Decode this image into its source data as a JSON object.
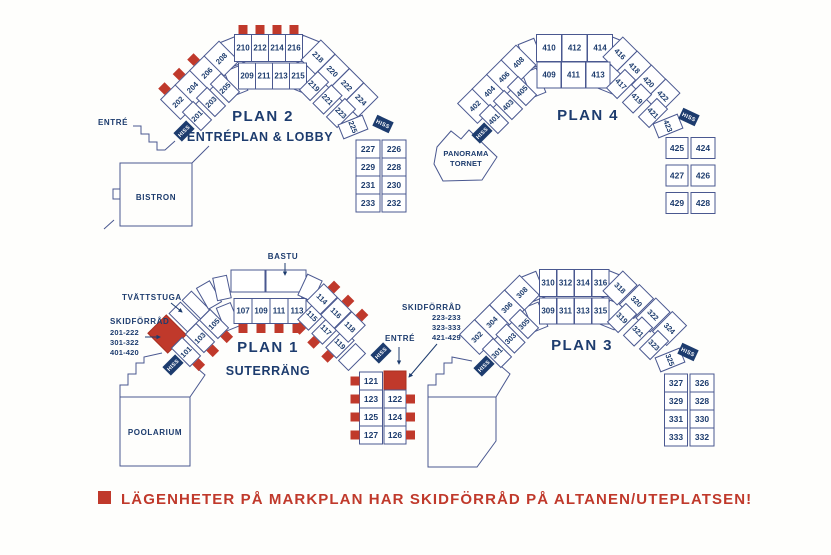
{
  "colors": {
    "navy_text": "#1d3c6e",
    "line": "#4a5890",
    "red_marker": "#c0392b",
    "hiss_background": "#1d3c6e",
    "hiss_text": "#ffffff",
    "background": "#fefefc"
  },
  "hiss_label": "HISS",
  "legend": {
    "text": "LÄGENHETER PÅ MARKPLAN HAR SKIDFÖRRÅD PÅ ALTANEN/UTEPLATSEN!"
  },
  "plans": {
    "plan2": {
      "title": "PLAN 2",
      "subtitle": "ENTRÉPLAN & LOBBY",
      "entre": "ENTRÉ",
      "bistron": "BISTRON",
      "rooms": {
        "outer_diag": [
          "202",
          "204",
          "206",
          "208"
        ],
        "outer_top": [
          "210",
          "212",
          "214",
          "216"
        ],
        "outer_diag_r": [
          "218",
          "220",
          "222",
          "224"
        ],
        "inner_diag": [
          "201",
          "203",
          "205"
        ],
        "inner_top": [
          "209",
          "211",
          "213",
          "215"
        ],
        "inner_diag_r": [
          "219",
          "221",
          "223"
        ],
        "inner_turn": [
          "225"
        ],
        "col_inner": [
          "227",
          "229",
          "231",
          "233"
        ],
        "col_outer": [
          "226",
          "228",
          "230",
          "232"
        ]
      },
      "marked": [
        "202",
        "204",
        "206",
        "210",
        "212",
        "214",
        "216"
      ]
    },
    "plan4": {
      "title": "PLAN 4",
      "panorama": [
        "PANORAMA",
        "TORNET"
      ],
      "rooms": {
        "outer_diag": [
          "402",
          "404",
          "406",
          "408"
        ],
        "outer_top": [
          "410",
          "412",
          "414"
        ],
        "outer_diag_r": [
          "416",
          "418",
          "420",
          "422"
        ],
        "inner_diag": [
          "401",
          "403",
          "405"
        ],
        "inner_top": [
          "409",
          "411",
          "413"
        ],
        "inner_diag_r": [
          "417",
          "419",
          "421"
        ],
        "inner_turn": [
          "423"
        ],
        "col_inner": [
          "425",
          "427",
          "429"
        ],
        "col_outer": [
          "424",
          "426",
          "428"
        ]
      },
      "marked": []
    },
    "plan1": {
      "title": "PLAN 1",
      "subtitle": "SUTERRÄNG",
      "entre": "ENTRÉ",
      "bastu": "BASTU",
      "tvattstuga": "TVÄTTSTUGA",
      "poolarium": "POOLARIUM",
      "skidforrad_left": {
        "label": "SKIDFÖRRÅD",
        "ranges": [
          "201-222",
          "301-322",
          "401-420"
        ]
      },
      "skidforrad_right": {
        "label": "SKIDFÖRRÅD",
        "ranges": [
          "223-233",
          "323-333",
          "421-429"
        ]
      },
      "rooms": {
        "inner_diag": [
          "101",
          "103",
          "105"
        ],
        "inner_top": [
          "107",
          "109",
          "111",
          "113"
        ],
        "inner_diag_r": [
          "115",
          "117",
          "119"
        ],
        "outer_diag_r": [
          "114",
          "116",
          "118"
        ],
        "col_inner": [
          "121",
          "123",
          "125",
          "127"
        ],
        "col_outer": [
          "122",
          "124",
          "126"
        ]
      },
      "marked": [
        "101",
        "103",
        "105",
        "107",
        "109",
        "111",
        "113",
        "114",
        "115",
        "116",
        "117",
        "118",
        "119",
        "121",
        "122",
        "123",
        "124",
        "125",
        "126",
        "127"
      ]
    },
    "plan3": {
      "title": "PLAN 3",
      "rooms": {
        "outer_diag": [
          "302",
          "304",
          "306",
          "308"
        ],
        "outer_top": [
          "310",
          "312",
          "314",
          "316"
        ],
        "outer_diag_r": [
          "318",
          "320",
          "322",
          "324"
        ],
        "inner_diag": [
          "301",
          "303",
          "305"
        ],
        "inner_top": [
          "309",
          "311",
          "313",
          "315"
        ],
        "inner_diag_r": [
          "319",
          "321",
          "323"
        ],
        "inner_turn": [
          "325"
        ],
        "col_inner": [
          "327",
          "329",
          "331",
          "333"
        ],
        "col_outer": [
          "326",
          "328",
          "330",
          "332"
        ]
      },
      "marked": []
    }
  }
}
